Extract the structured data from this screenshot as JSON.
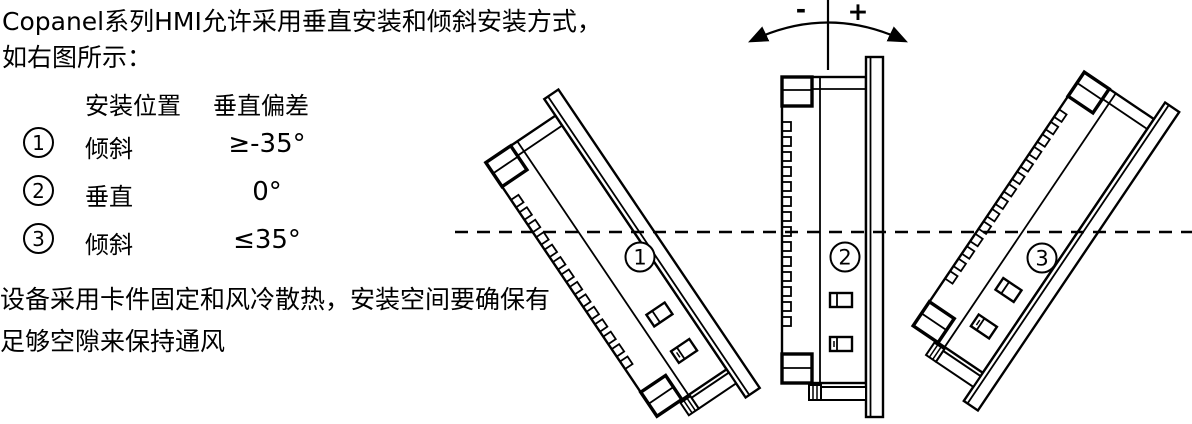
{
  "intro": {
    "line1": "Copanel系列HMI允许采用垂直安装和倾斜安装方式，",
    "line2": "如右图所示："
  },
  "table": {
    "headers": [
      "安装位置",
      "垂直偏差"
    ],
    "rows": [
      {
        "num": "1",
        "position": "倾斜",
        "deviation": "≥-35°"
      },
      {
        "num": "2",
        "position": "垂直",
        "deviation": "0°"
      },
      {
        "num": "3",
        "position": "倾斜",
        "deviation": "≤35°"
      }
    ]
  },
  "note": {
    "line1": "设备采用卡件固定和风冷散热，安装空间要确保有",
    "line2": "足够空隙来保持通风"
  },
  "diagram": {
    "tilt_minus_label": "-",
    "tilt_plus_label": "+",
    "panels": [
      {
        "label": "1",
        "cx": 652,
        "cy": 243.5,
        "rotation": -34
      },
      {
        "label": "2",
        "cx": 874.5,
        "cy": 237,
        "rotation": 0
      },
      {
        "label": "3",
        "cx": 1071.5,
        "cy": 256.5,
        "rotation": 34
      }
    ],
    "line_color": "#000000",
    "background_color": "#ffffff"
  }
}
